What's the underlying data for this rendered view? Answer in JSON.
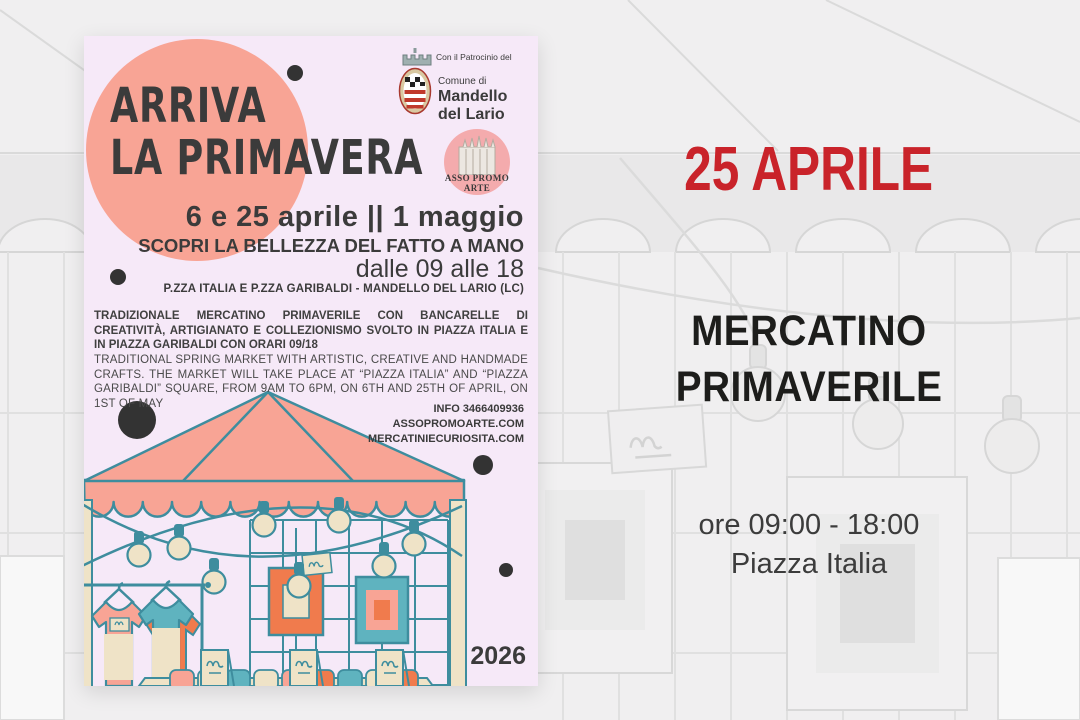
{
  "poster": {
    "headline": {
      "line1": "ARRIVA",
      "line2": "LA PRIMAVERA"
    },
    "patronage": {
      "intro": "Con il Patrocinio del",
      "comune": "Comune di",
      "name_line1": "Mandello",
      "name_line2": "del Lario"
    },
    "asso_logo": {
      "line1": "ASSO PROMO",
      "line2": "ARTE"
    },
    "dates_line": "6 e 25 aprile || 1 maggio",
    "tagline": "SCOPRI LA BELLEZZA DEL FATTO A MANO",
    "hours_line": "dalle 09 alle 18",
    "location_line": "P.ZZA ITALIA E P.ZZA GARIBALDI - MANDELLO DEL LARIO (LC)",
    "description_it": "TRADIZIONALE MERCATINO PRIMAVERILE CON BANCARELLE DI CREATIVITÀ, ARTIGIANATO E COLLEZIONISMO SVOLTO IN PIAZZA ITALIA E IN PIAZZA GARIBALDI CON ORARI 09/18",
    "description_en": "TRADITIONAL SPRING MARKET WITH ARTISTIC, CREATIVE AND HANDMADE CRAFTS. THE MARKET WILL TAKE PLACE AT “PIAZZA ITALIA” AND “PIAZZA GARIBALDI” SQUARE, FROM 9AM TO 6PM, ON 6TH AND 25TH OF APRIL, ON 1ST OF MAY",
    "info": {
      "line1": "INFO 3466409936",
      "line2": "ASSOPROMOARTE.COM",
      "line3": "MERCATINIECURIOSITA.COM"
    },
    "year": "2026"
  },
  "event_panel": {
    "date": "25 APRILE",
    "title_line1": "MERCATINO",
    "title_line2": "PRIMAVERILE",
    "time": "ore 09:00 - 18:00",
    "place": "Piazza Italia"
  },
  "colors": {
    "accent_red": "#C9232A",
    "title_dark": "#1D1D1B",
    "canvas_bg": "#F0EFF0",
    "poster_bg": "#F6E9F8",
    "salmon": "#F8A495",
    "teal": "#5FB3BF",
    "teal_outline": "#3E8D9E",
    "cream": "#EFE3C7",
    "orange": "#F07B4D",
    "charcoal": "#3B3B3B",
    "faded_line": "#D8D8D8",
    "faded_fill": "#E9E8E9"
  }
}
